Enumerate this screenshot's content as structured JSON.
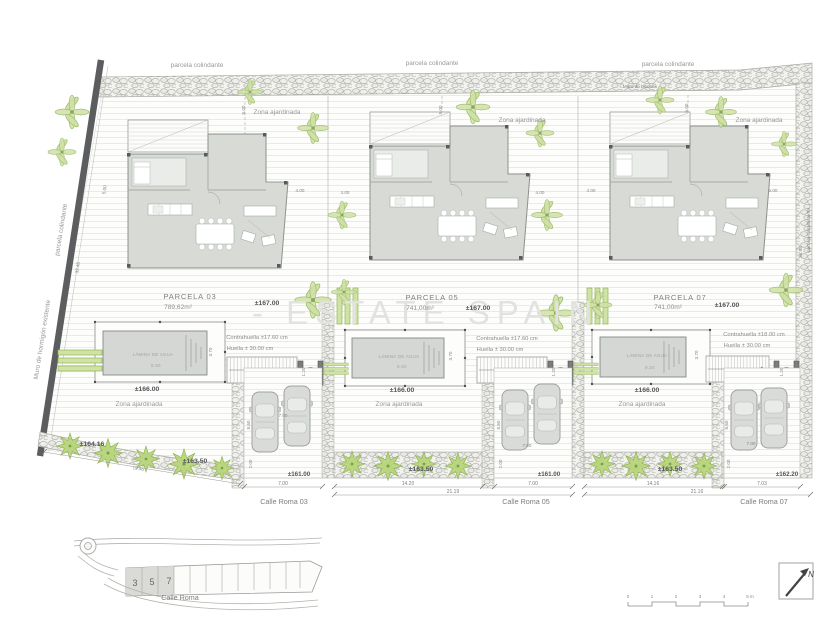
{
  "site": {
    "watermark": "- ESTATE SPAIN",
    "boundaries": {
      "top_label": "parcela colindante",
      "top_wall_note": "Muro de bloques",
      "left_wall_label": "Muro de hormigón existente",
      "left_label": "parcela colindante",
      "right_label": "parcela colindante 09",
      "left_dims": {
        "offset": "5.00",
        "length": "32.48"
      },
      "right_dim": "36.98"
    },
    "front_levels": {
      "left_curve": "±164.16"
    },
    "symbols": {
      "palm": "palm-plant",
      "shrub": "shrub-plant",
      "car": "parked-car",
      "gate": "entrance-gate"
    }
  },
  "parcels": [
    {
      "name": "PARCELA 03",
      "area": "789,62m²",
      "level": "±167.00",
      "garden_top": "Zona ajardinada",
      "garden_bottom": "Zona ajardinada",
      "stair_note_1": "Contrahuella  ±17.60 cm",
      "stair_note_2": "Huella ± 30.00 cm",
      "pool": {
        "label": "LÁMINA DE AGUA",
        "length": "8.50",
        "width": "3.70",
        "deck_level": "±166.00"
      },
      "levels": {
        "garden_strip": "±163.50",
        "street": "±161.00"
      },
      "street_name": "Calle Roma 03",
      "dims": {
        "setback_top": "5.00",
        "setback_side": "4.00",
        "drive_width": "7.00",
        "drive_depth": "8.60",
        "sidewalk": "2.00",
        "gate_width": "1.20",
        "street_front": "7.00",
        "frontage": "19.46"
      }
    },
    {
      "name": "PARCELA 05",
      "area": "741,00m²",
      "level": "±167.00",
      "garden_top": "Zona ajardinada",
      "garden_bottom": "Zona ajardinada",
      "stair_note_1": "Contrahuella  ±17.60 cm",
      "stair_note_2": "Huella ± 30.00 cm",
      "pool": {
        "label": "LÁMINA DE AGUA",
        "length": "8.50",
        "width": "3.70",
        "deck_level": "±166.00"
      },
      "levels": {
        "garden_strip": "±163.50",
        "street": "±161.00"
      },
      "street_name": "Calle Roma 05",
      "dims": {
        "setback_top": "5.00",
        "setback_side_left": "4.00",
        "setback_side_right": "4.00",
        "drive_width": "7.00",
        "drive_depth": "8.60",
        "sidewalk": "2.00",
        "gate_width": "1.20",
        "street_front": "7.00",
        "garden_front": "14.20",
        "total_front": "21.19"
      }
    },
    {
      "name": "PARCELA 07",
      "area": "741,00m²",
      "level": "±167.00",
      "garden_top": "Zona ajardinada",
      "garden_bottom": "Zona ajardinada",
      "stair_note_1": "Contrahuella  ±18.00 cm",
      "stair_note_2": "Huella ± 30.00 cm",
      "pool": {
        "label": "LÁMINA DE AGUA",
        "length": "9.20",
        "width": "3.70",
        "deck_level": "±166.00"
      },
      "levels": {
        "garden_strip": "±163.50",
        "street": "±162.20"
      },
      "street_name": "Calle Roma 07",
      "dims": {
        "setback_top": "5.00",
        "setback_side_left": "4.00",
        "setback_side_right": "5.00",
        "drive_width": "7.00",
        "drive_depth": "8.60",
        "sidewalk": "2.00",
        "gate_width": "1.20",
        "street_front": "7.03",
        "garden_front": "14.16",
        "total_front": "21.16"
      }
    }
  ],
  "inset_map": {
    "parcel_numbers": [
      "3",
      "5",
      "7"
    ],
    "street": "Calle Roma"
  },
  "scale_bar": {
    "ticks": [
      "0",
      "1",
      "2",
      "3",
      "4",
      "5 m"
    ]
  },
  "north_arrow": {
    "label": "N"
  }
}
